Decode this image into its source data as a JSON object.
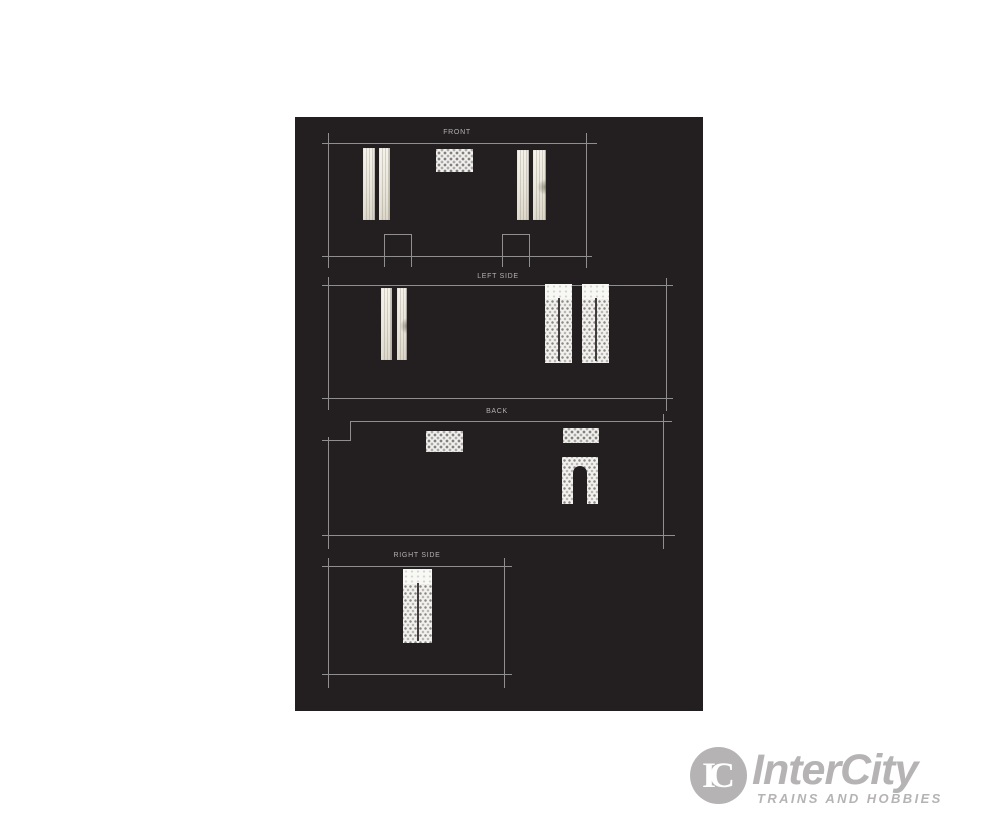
{
  "artwork": {
    "sections": [
      {
        "id": "front",
        "label": "FRONT"
      },
      {
        "id": "left-side",
        "label": "LEFT SIDE"
      },
      {
        "id": "back",
        "label": "BACK"
      },
      {
        "id": "right-side",
        "label": "RIGHT SIDE"
      }
    ]
  },
  "logo": {
    "monogram": "IC",
    "name": "InterCity",
    "tagline": "TRAINS AND HOBBIES"
  },
  "colors": {
    "panel_bg": "#231f20",
    "line_gray": "#8f8f8f",
    "label_gray": "#b2b0b0",
    "logo_gray": "#b5b3b3",
    "curtain_cream": "#ece9e1",
    "lace_white": "#f2f1ee"
  }
}
